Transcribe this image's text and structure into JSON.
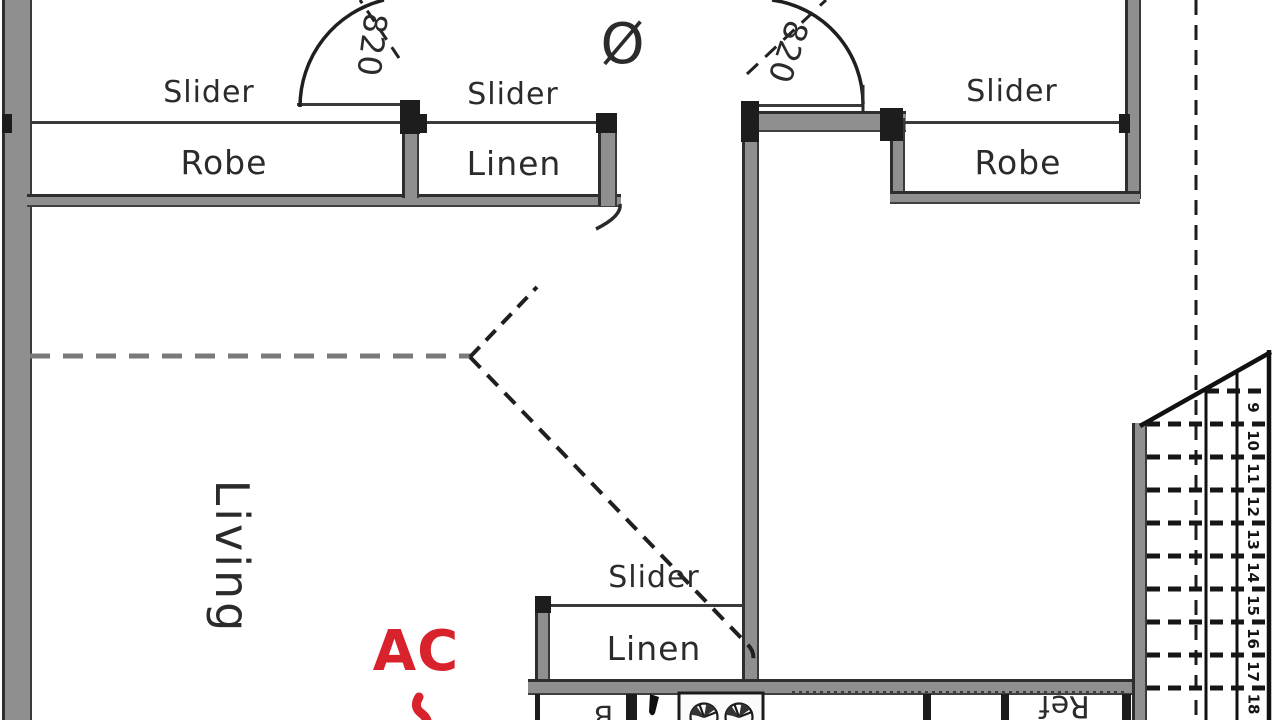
{
  "labels": {
    "slider_top_left": "Slider",
    "robe_left": "Robe",
    "slider_top_mid": "Slider",
    "linen_top": "Linen",
    "slider_top_right": "Slider",
    "robe_right": "Robe",
    "slider_bottom": "Slider",
    "linen_bottom": "Linen",
    "living": "Living",
    "ac": "AC",
    "ref": "Ref",
    "partial_letter": "B",
    "door_left_dim": "820",
    "door_right_dim": "820",
    "diameter_symbol": "Ø"
  },
  "stairs": {
    "numbers": [
      "9",
      "10",
      "11",
      "12",
      "13",
      "14",
      "15",
      "16",
      "17",
      "18"
    ]
  },
  "colors": {
    "wall_gray": "#8f8f8f",
    "line_dark": "#222222",
    "annotation_red": "#d8232d"
  }
}
